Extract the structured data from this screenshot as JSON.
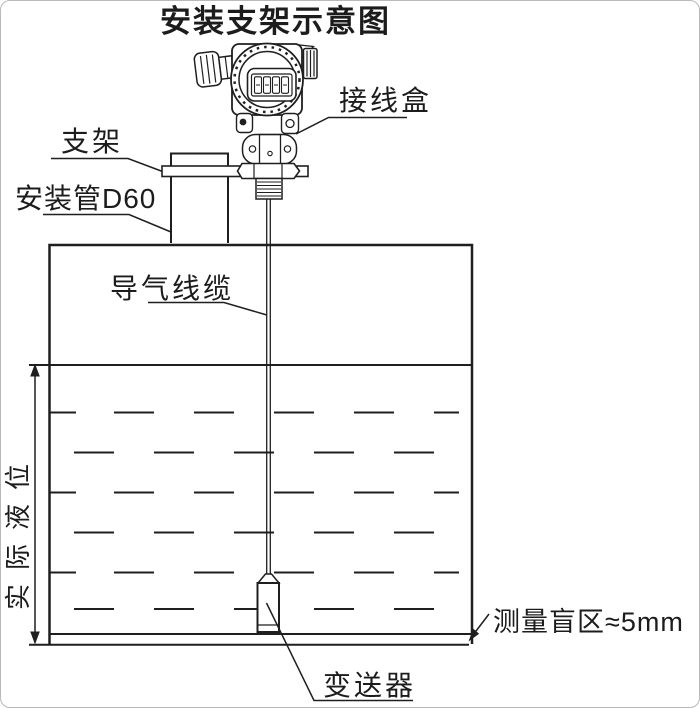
{
  "diagram": {
    "title": "安装支架示意图",
    "labels": {
      "junction_box": "接线盒",
      "bracket": "支架",
      "mounting_pipe": "安装管D60",
      "air_cable": "导气线缆",
      "actual_level": "实际液位",
      "blind_zone": "测量盲区≈5mm",
      "transmitter": "变送器"
    },
    "colors": {
      "line": "#1f1f1f",
      "background": "#ffffff"
    }
  }
}
